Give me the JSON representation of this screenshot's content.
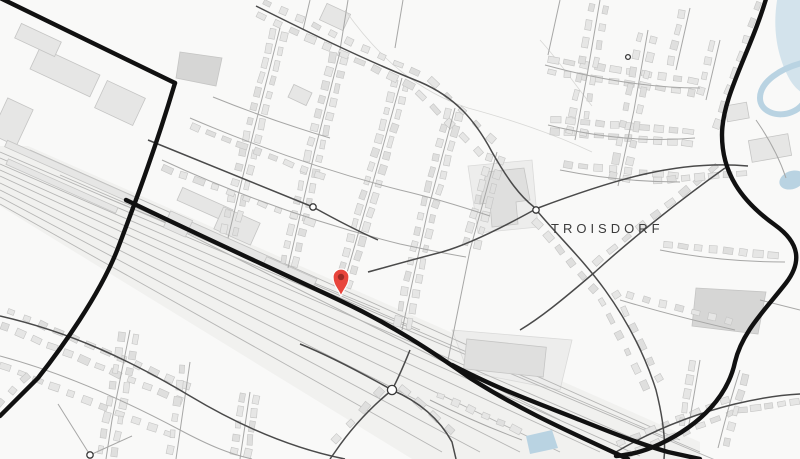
{
  "map": {
    "place_label": {
      "text": "TROISDORF",
      "x": 551,
      "y": 221
    },
    "marker": {
      "name": "location-pin",
      "x": 341,
      "y": 296
    },
    "colors": {
      "background": "#f9f9f8",
      "rail_corridor": "#f1f1ef",
      "zone_fill": "#ededec",
      "zone_stroke": "#dadad9",
      "building_fill": "#e6e6e5",
      "building_alt": "#dfdfde",
      "building_dark": "#d6d6d5",
      "building_stroke": "#c5c5c4",
      "rail_line": "#b6b6b5",
      "minor_road": "#a7a7a6",
      "medium_road": "#4a4a4a",
      "major_road": "#111111",
      "junction_fill": "#ffffff",
      "junction_stroke": "#3a3a3a",
      "water": "#d3e3ec",
      "stream": "#b9d3e2",
      "label": "#3b3b3b",
      "pin": "#e8453c",
      "pin_inner": "#9c2b26",
      "pin_rim": "#ffffff",
      "faint_line": "#d8d8d6"
    }
  }
}
